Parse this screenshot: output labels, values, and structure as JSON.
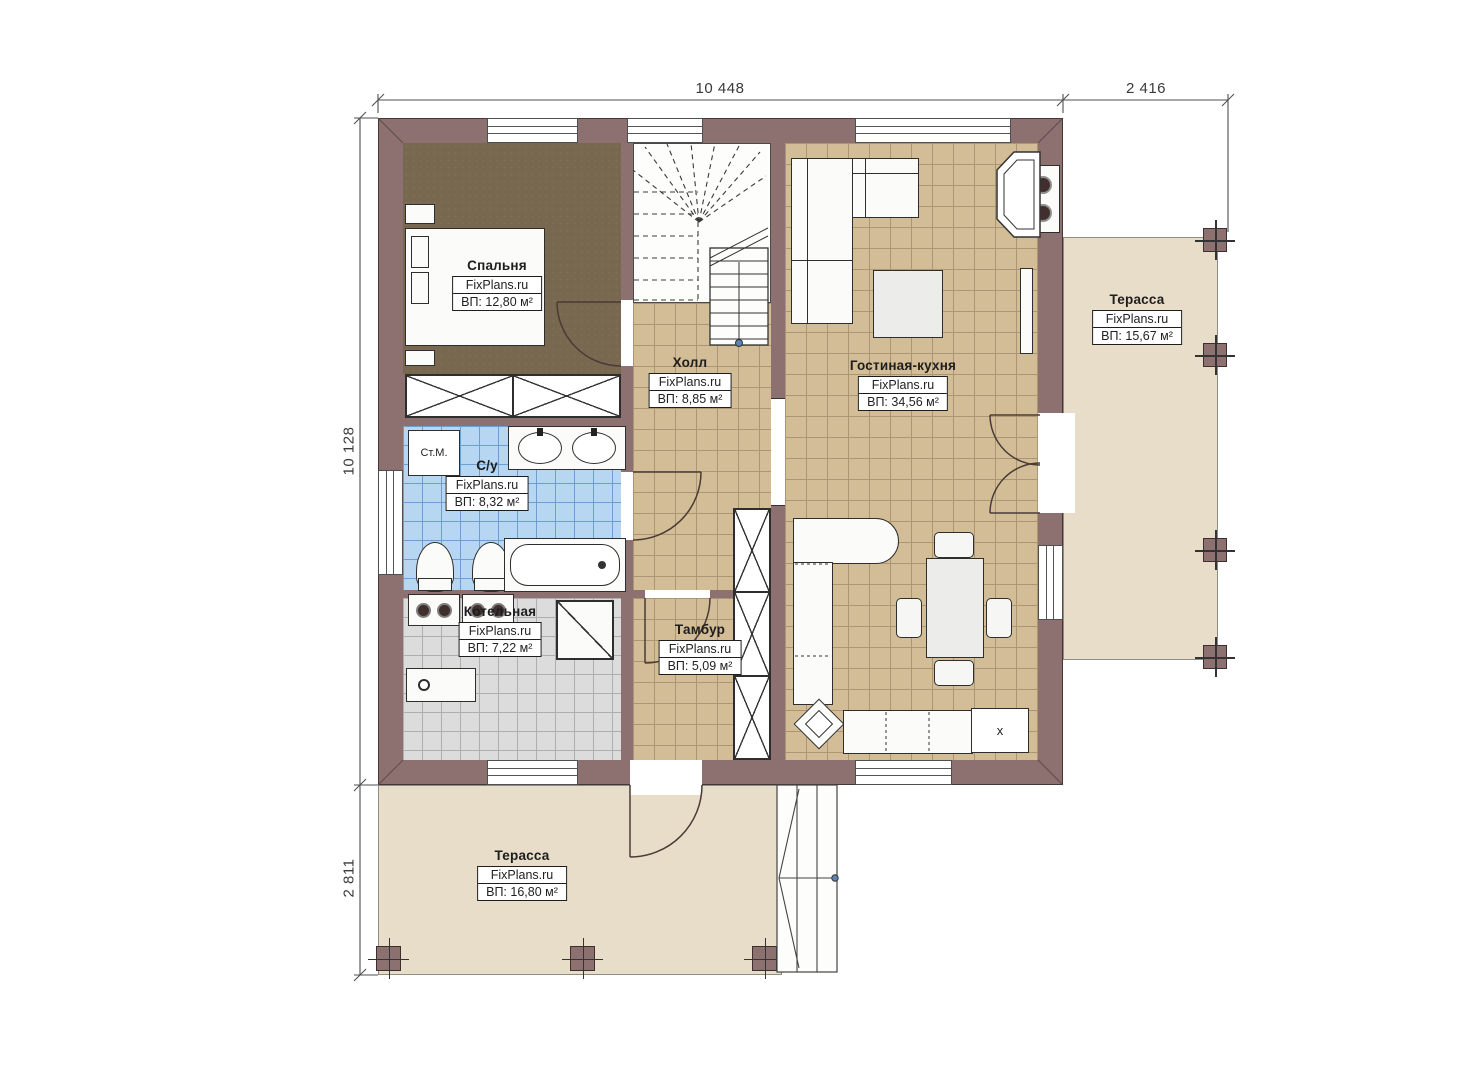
{
  "dimensions": {
    "top_main": "10 448",
    "top_terrace": "2 416",
    "left_main": "10 128",
    "left_terrace": "2 811"
  },
  "rooms": [
    {
      "key": "bedroom",
      "name": "Спальня",
      "brand": "FixPlans.ru",
      "area": "ВП: 12,80 м²"
    },
    {
      "key": "hall",
      "name": "Холл",
      "brand": "FixPlans.ru",
      "area": "ВП: 8,85 м²"
    },
    {
      "key": "living_kitchen",
      "name": "Гостиная-кухня",
      "brand": "FixPlans.ru",
      "area": "ВП: 34,56 м²"
    },
    {
      "key": "terrace_right",
      "name": "Терасса",
      "brand": "FixPlans.ru",
      "area": "ВП: 15,67 м²"
    },
    {
      "key": "bathroom",
      "name": "С/у",
      "brand": "FixPlans.ru",
      "area": "ВП: 8,32 м²"
    },
    {
      "key": "boiler",
      "name": "Котельная",
      "brand": "FixPlans.ru",
      "area": "ВП: 7,22 м²"
    },
    {
      "key": "vestibule",
      "name": "Тамбур",
      "brand": "FixPlans.ru",
      "area": "ВП: 5,09 м²"
    },
    {
      "key": "terrace_bottom",
      "name": "Терасса",
      "brand": "FixPlans.ru",
      "area": "ВП: 16,80 м²"
    }
  ],
  "appliances": {
    "washing_machine": "Ст.М.",
    "fridge": "x"
  },
  "colors": {
    "wall": "#8c7170",
    "tile_tan": "#d3bd96",
    "tile_blue": "#b7d6f2",
    "tile_gray": "#dcdcdc",
    "bedroom_floor": "#77684f",
    "terrace": "#e7ddc9"
  }
}
